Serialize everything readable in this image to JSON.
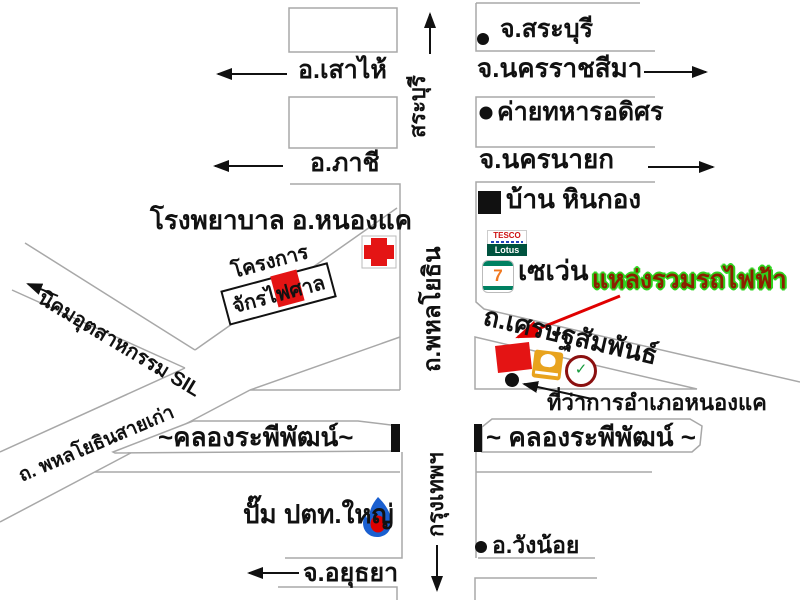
{
  "map_title": "hand-drawn directions map (Nong Khae / Hin Kong area)",
  "colors": {
    "background": "#ffffff",
    "road_outline_gray": "#a8a8a8",
    "ink_black": "#111111",
    "landmark_red": "#e41414",
    "highlight_arrow_red": "#e00000",
    "highlight_text_dark_red": "#8b2000",
    "highlight_text_green_outline": "#2fd41f",
    "tesco_green": "#00533f",
    "tesco_red": "#cc1111",
    "seven_eleven_green": "#008061",
    "seven_eleven_orange": "#f07820",
    "ptt_flame_blue": "#1a5fd0",
    "ptt_drop_red": "#dd0000",
    "bank_logo_yellow": "#e8a31e",
    "bank_logo_ring_red": "#8b1010",
    "bank_logo_green": "#169b3c"
  },
  "labels": {
    "saraburi_province": "จ.สระบุรี",
    "saohai": "อ.เสาไห้",
    "nakhonratchasima": "จ.นครราชสีมา",
    "adisorn_camp": "ค่ายทหารอดิศร",
    "phachi": "อ.ภาชี",
    "nakhonnayok": "จ.นครนายก",
    "hinkong": "บ้าน หินกอง",
    "hospital": "โรงพยาบาล อ.หนองแค",
    "seven_eleven": "เซเว่น",
    "ev_highlight": "แหล่งรวมรถไฟฟ้า",
    "project_line1": "โครงการ",
    "project_line2": "จักรไฟศาล",
    "sil_estate": "นิคมอุตสาหกรรม SIL",
    "old_phahonyothin": "ถ. พหลโยธินสายเก่า",
    "setthasamphan_road": "ถ.เศรษฐสัมพันธ์",
    "district_office": "ที่ว่าการอำเภอหนองแค",
    "canal_left": "~คลองระพีพัฒน์~",
    "canal_right": "~ คลองระพีพัฒน์ ~",
    "ptt_station": "ปั๊ม ปตท.ใหญ่",
    "ayutthaya": "จ.อยุธยา",
    "wangnoi": "อ.วังน้อย",
    "saraburi_road_vertical": "สระบุรี",
    "phahonyothin_road_vertical": "ถ.พหลโยธิน",
    "bangkok_vertical": "กรุงเทพฯ"
  },
  "logos": {
    "tesco_top": "TESCO",
    "tesco_bottom": "Lotus",
    "seven_eleven_digit": "7"
  }
}
